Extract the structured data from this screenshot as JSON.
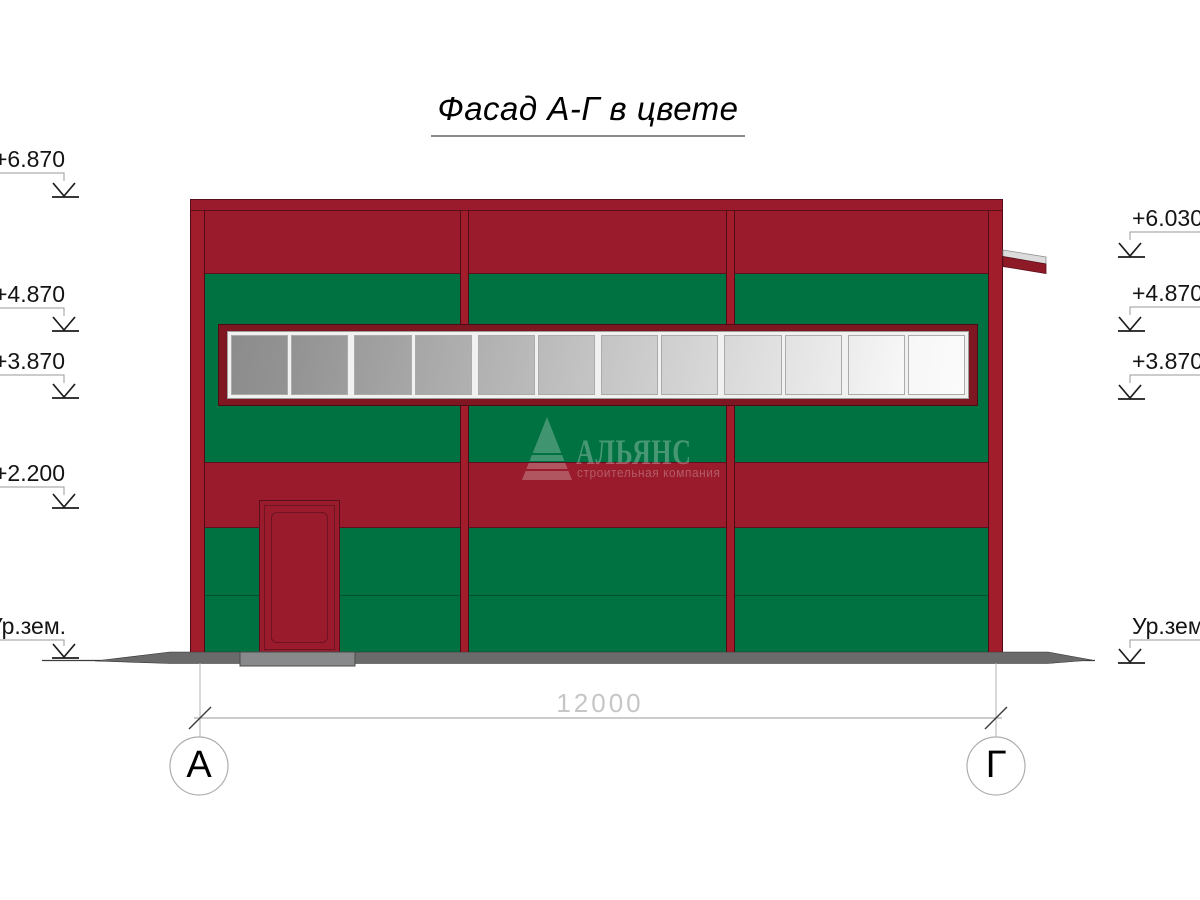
{
  "title": "Фасад А-Г в цвете",
  "watermark": {
    "name": "АЛЬЯНС",
    "tagline": "строительная компания"
  },
  "markers_left": [
    {
      "label": "+6.870"
    },
    {
      "label": "+4.870"
    },
    {
      "label": "+3.870"
    },
    {
      "label": "+2.200"
    },
    {
      "label": "Ур.зем."
    }
  ],
  "markers_right": [
    {
      "label": "+6.030"
    },
    {
      "label": "+4.870"
    },
    {
      "label": "+3.870"
    },
    {
      "label": "Ур.зем."
    }
  ],
  "dimension": {
    "value": "12000"
  },
  "axes": [
    {
      "label": "А"
    },
    {
      "label": "Г"
    }
  ],
  "windows": {
    "pane_count": 12,
    "glass_from": "#8c8c8c",
    "glass_to": "#fbfbfb"
  },
  "colors": {
    "facade_red": "#9a1b2b",
    "pilaster_red": "#a11d2b",
    "facade_red_dark": "#7f1722",
    "facade_green": "#007140",
    "ground_gray": "#6a6a6a",
    "canopy_white": "#dcdcdc",
    "dimension_gray": "#c6c6c6"
  }
}
